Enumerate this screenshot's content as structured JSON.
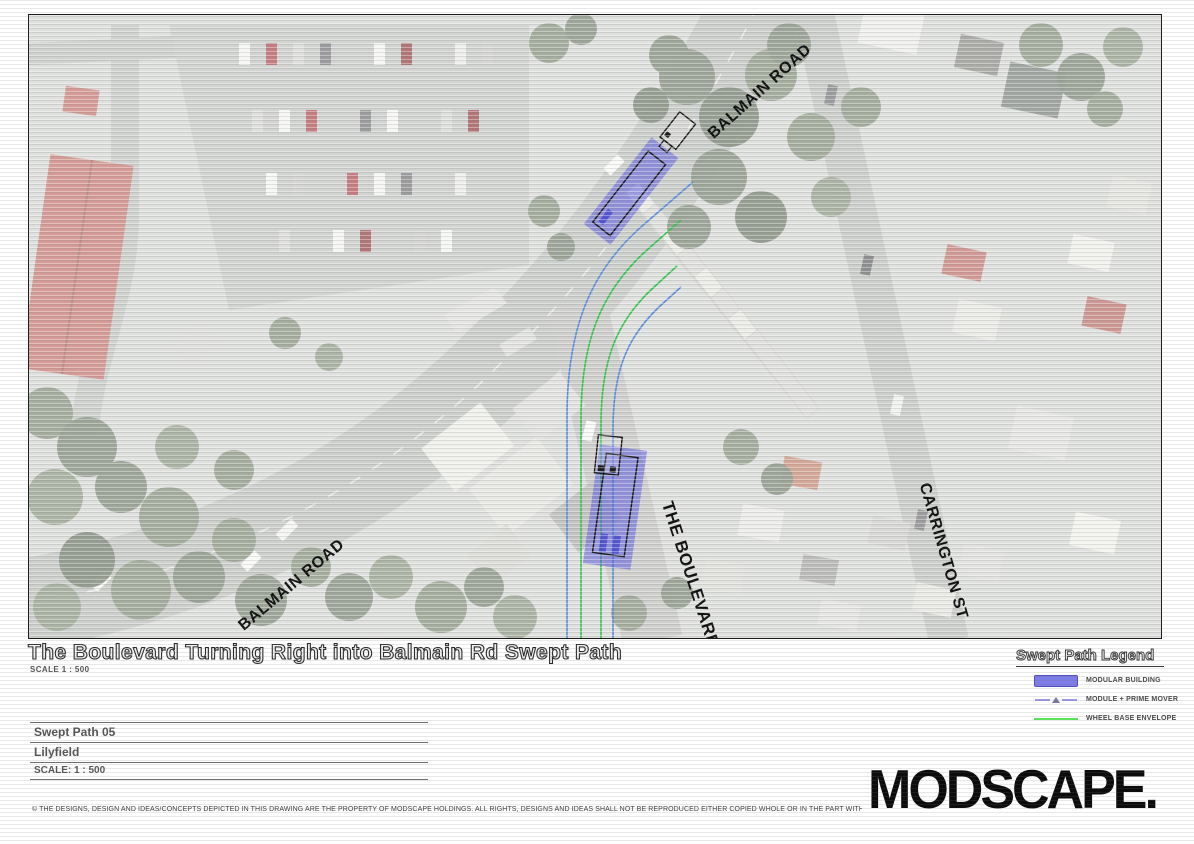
{
  "map": {
    "road_labels": [
      {
        "id": "balmain-road-top",
        "text": "BALMAIN ROAD"
      },
      {
        "id": "balmain-road-bottom",
        "text": "BALMAIN ROAD"
      },
      {
        "id": "the-boulevarde",
        "text": "THE BOULEVARDE"
      },
      {
        "id": "carrington-st",
        "text": "CARRINGTON ST"
      }
    ]
  },
  "sheet": {
    "title": "The Boulevard Turning Right into Balmain Rd Swept Path",
    "title_scale": "SCALE  1 : 500"
  },
  "legend": {
    "title": "Swept Path Legend",
    "items": [
      {
        "label": "MODULAR BUILDING",
        "swatch": "solid-blue-rect"
      },
      {
        "label": "MODULE + PRIME MOVER",
        "swatch": "dashed-line-triangle"
      },
      {
        "label": "WHEEL BASE ENVELOPE",
        "swatch": "green-line"
      }
    ]
  },
  "title_block": {
    "drawing_name": "Swept Path 05",
    "location": "Lilyfield",
    "scale": "SCALE: 1 : 500"
  },
  "branding": {
    "logo": "MODSCAPE."
  },
  "footer": {
    "disclaimer": "© THE DESIGNS, DESIGN AND IDEAS/CONCEPTS DEPICTED IN THIS DRAWING ARE THE PROPERTY OF MODSCAPE HOLDINGS. ALL RIGHTS, DESIGNS AND IDEAS SHALL NOT BE REPRODUCED EITHER COPIED WHOLE OR IN THE PART WITHOUT THE WRITTEN PERMISSION OF MODSCAPE HOLDINGS PTY LTD"
  },
  "colors": {
    "module_fill": "#5c5ce0",
    "legend_module_swatch": "#7d7de8",
    "body_envelope_line": "#5b8dd9",
    "wheel_base_line": "#37c24d"
  }
}
